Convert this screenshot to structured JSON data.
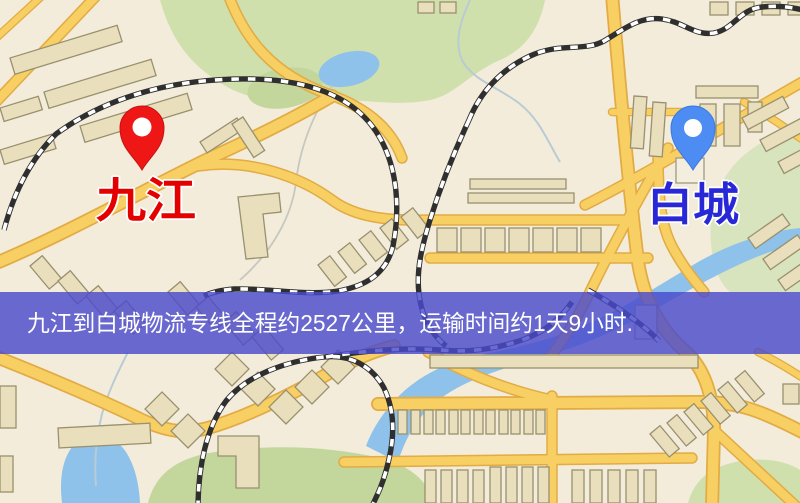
{
  "map": {
    "origin_pin": {
      "color": "#ef1616"
    },
    "destination_pin": {
      "color": "#4d8cf2"
    },
    "origin_label": {
      "text": "九江",
      "color": "#e50000"
    },
    "destination_label": {
      "text": "白城",
      "color": "#2828d7"
    }
  },
  "banner": {
    "text": "九江到白城物流专线全程约2527公里，运输时间约1天9小时.",
    "bg_color": "#4a4acc",
    "text_color": "#ffffff"
  },
  "palette": {
    "map_background": "#f3ecda",
    "road_fill": "#f7cf63",
    "road_edge": "#e2ab44",
    "building": "#e9dfbd",
    "park_green": "#cfe0ad",
    "water_blue": "#8fc2ea",
    "railway_dark": "#2f2f2f"
  }
}
